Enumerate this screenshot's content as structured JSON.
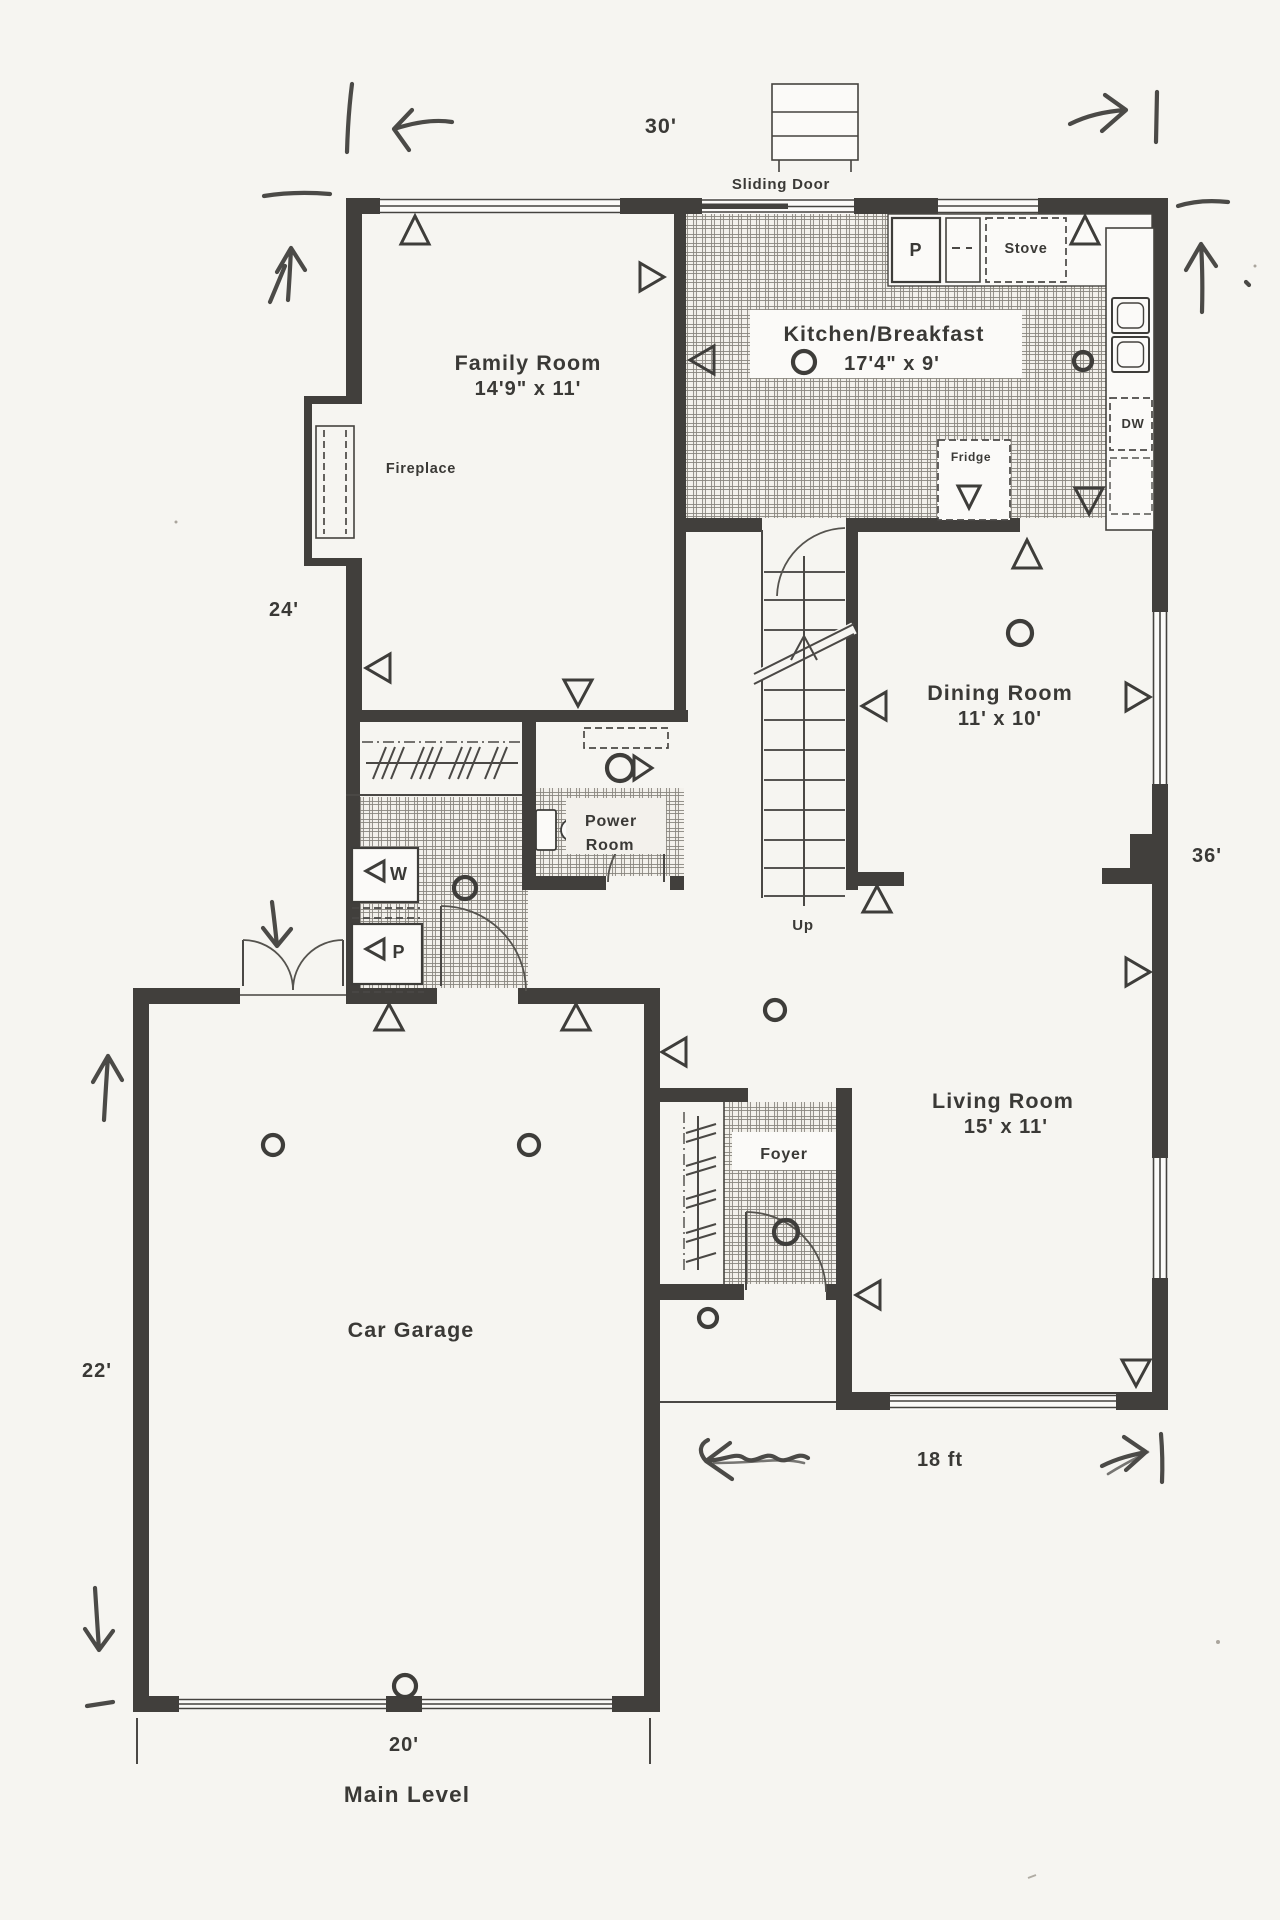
{
  "rooms": {
    "family_room": {
      "name": "Family Room",
      "dims": "14'9\" x 11'"
    },
    "kitchen_breakfast": {
      "name": "Kitchen/Breakfast",
      "dims": "17'4\" x 9'"
    },
    "dining_room": {
      "name": "Dining Room",
      "dims": "11' x 10'"
    },
    "living_room": {
      "name": "Living Room",
      "dims": "15' x 11'"
    },
    "car_garage": {
      "name": "Car Garage"
    },
    "power_room": {
      "name": "Power Room",
      "lines": [
        "Power",
        "Room"
      ]
    },
    "foyer": {
      "name": "Foyer"
    }
  },
  "features": {
    "fireplace": "Fireplace",
    "sliding_door": "Sliding Door",
    "stairs_up": "Up",
    "pantry": "P",
    "stove": "Stove",
    "dishwasher": "DW",
    "fridge": "Fridge",
    "washer": "W",
    "dryer_symbol": "P"
  },
  "dimensions": {
    "top_width": "30'",
    "left_upper": "24'",
    "right_height": "36'",
    "left_lower": "22'",
    "garage_width": "20'",
    "living_width": "18 ft"
  },
  "footer": {
    "level_label": "Main Level"
  },
  "colors": {
    "paper": "#f6f5f1",
    "wall": "#413f3c",
    "ink": "#3a3936",
    "pen": "#4b4a47"
  }
}
